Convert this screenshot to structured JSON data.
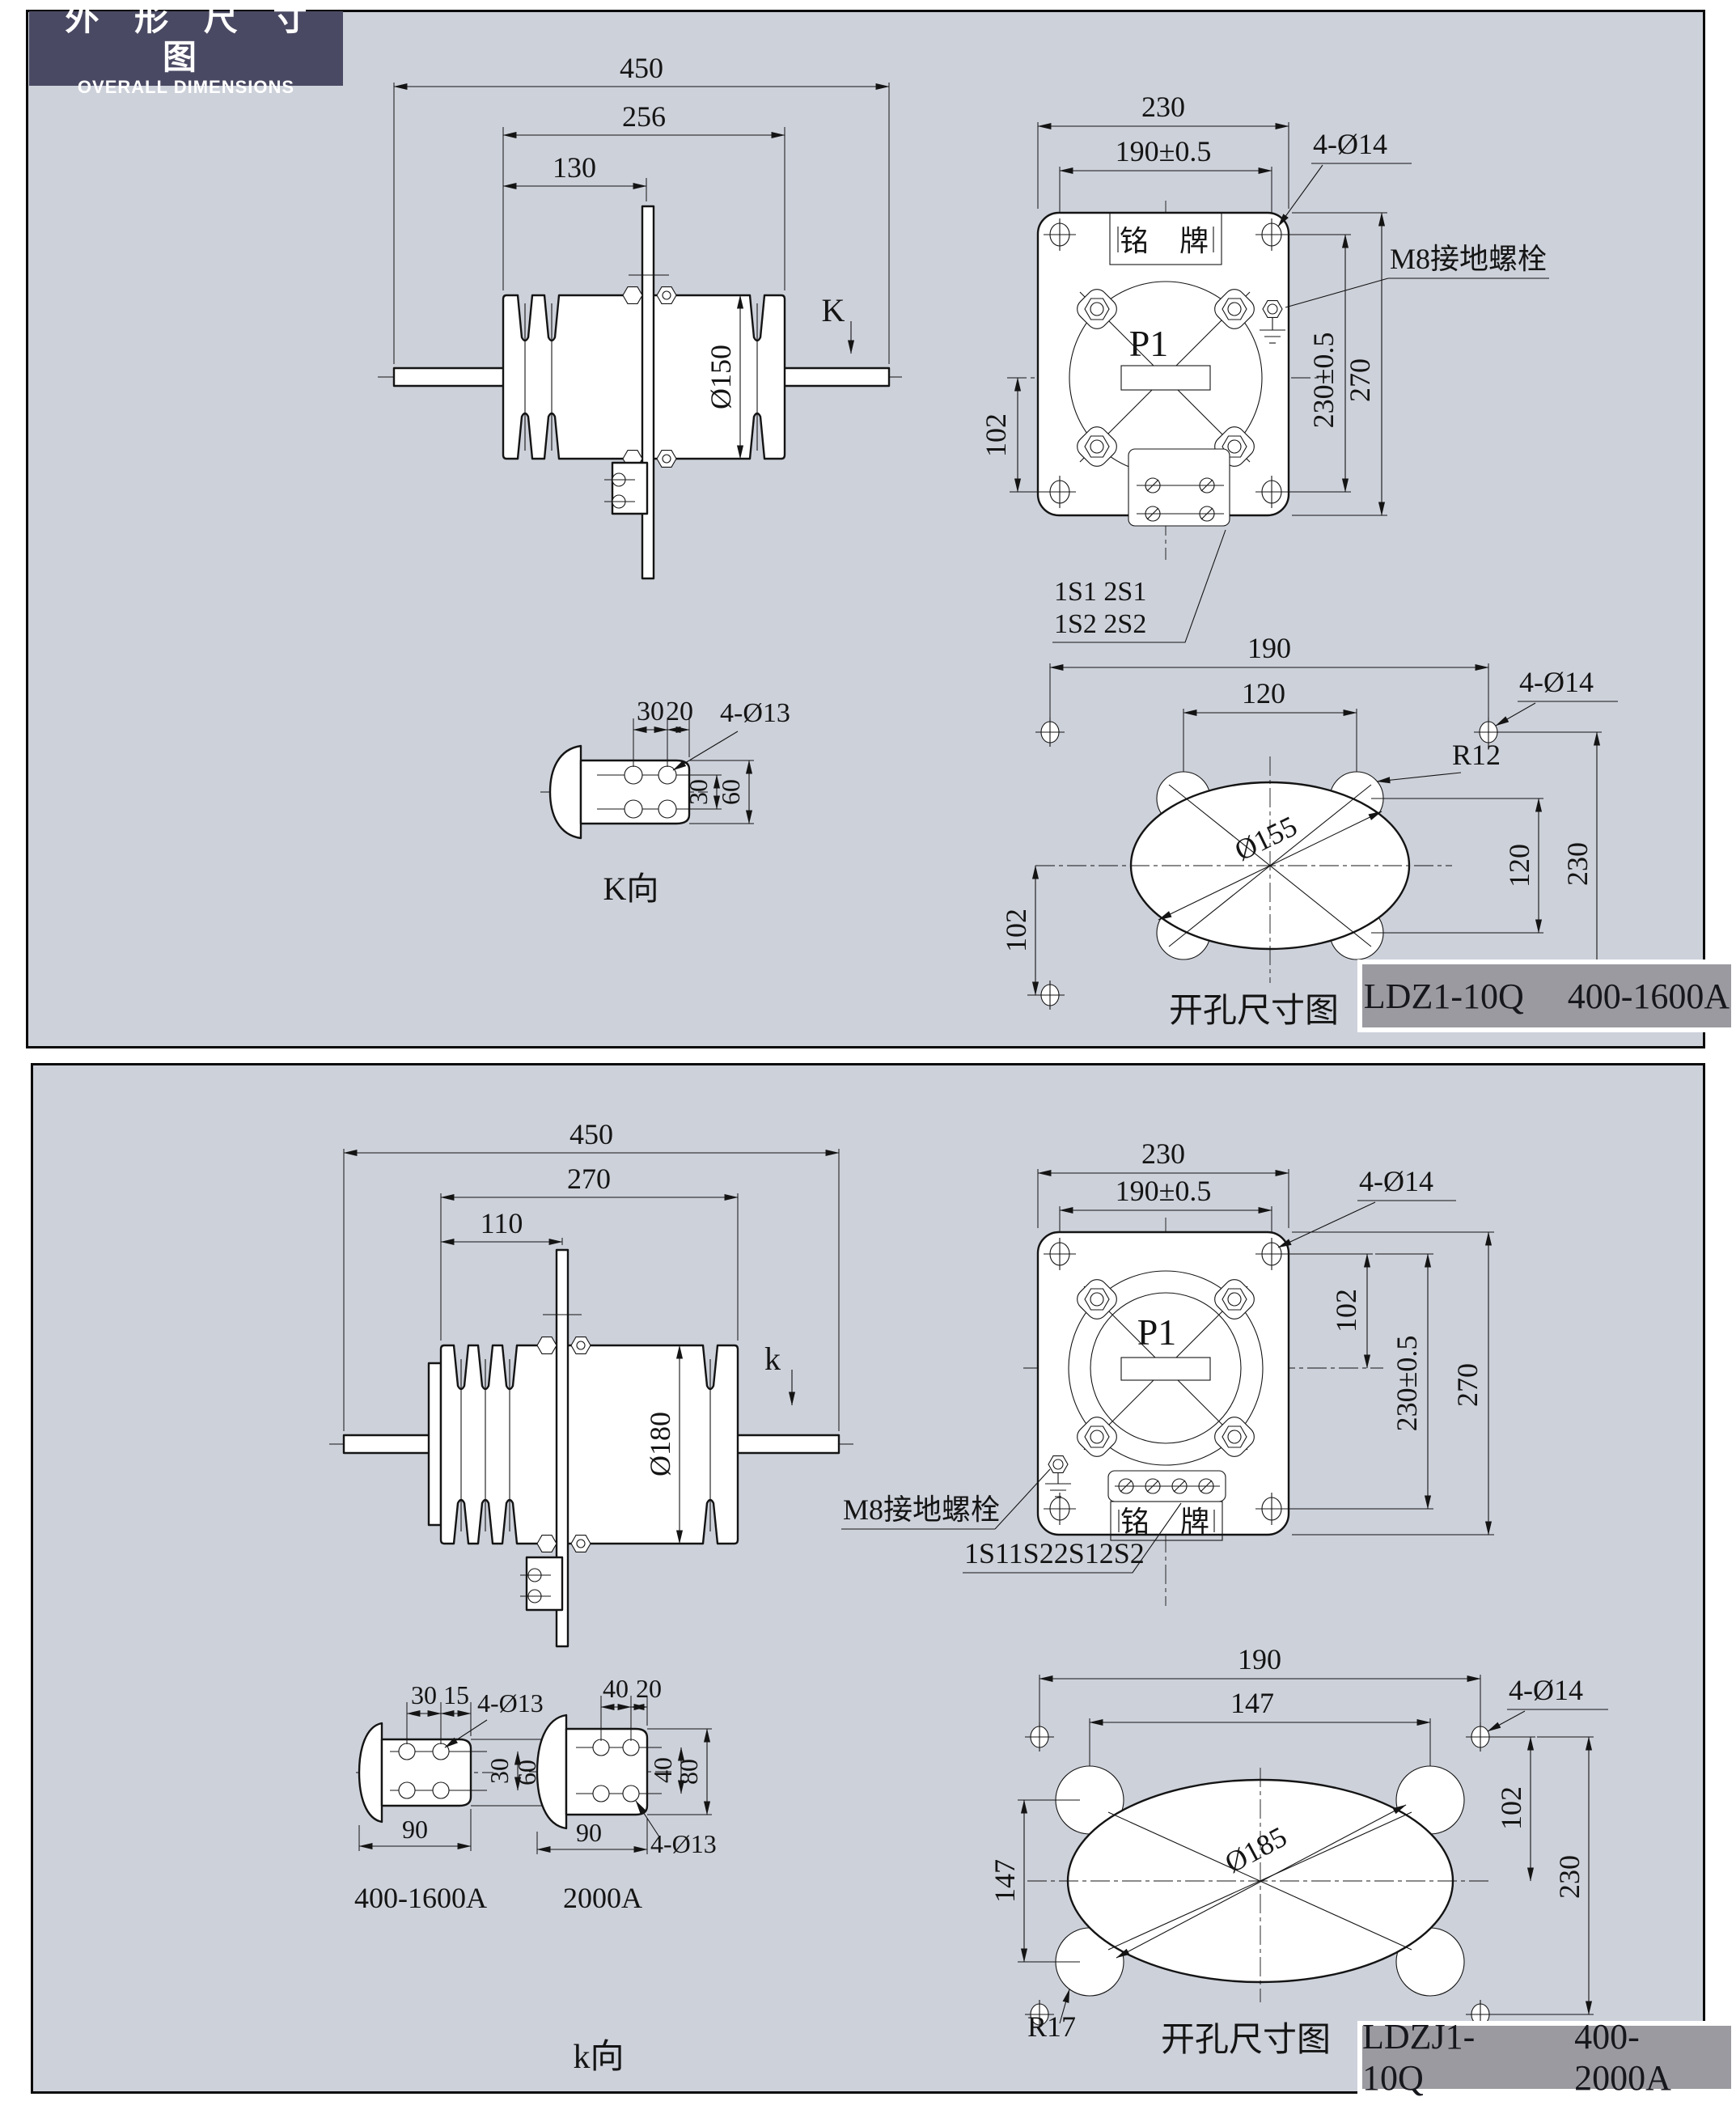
{
  "header": {
    "title_cn": "外 形 尺 寸 图",
    "title_en": "OVERALL DIMENSIONS"
  },
  "panel1": {
    "side_view": {
      "dim_total_length": "450",
      "dim_insulator_length": "256",
      "dim_plate_offset": "130",
      "dim_body_diameter": "Ø150",
      "view_label": "K"
    },
    "flange_view": {
      "dim_width": "230",
      "dim_hole_spacing_h": "190±0.5",
      "mounting_holes_label": "4-Ø14",
      "nameplate_label": "铭牌",
      "ground_bolt_label": "M8接地螺栓",
      "primary_terminal_label": "P1",
      "dim_center_to_bottom_holes": "102",
      "dim_hole_spacing_v": "230±0.5",
      "dim_height": "270",
      "secondary_terminals_row1": "1S1 2S1",
      "secondary_terminals_row2": "1S2 2S2"
    },
    "k_view": {
      "dim_hole_pitch_h": "30",
      "dim_hole_edge": "20",
      "holes_label": "4-Ø13",
      "dim_hole_pitch_v": "30",
      "dim_pad_width": "60",
      "caption": "K向"
    },
    "cutout_view": {
      "dim_hole_spacing_h": "190",
      "dim_lobe_spacing_h": "120",
      "mounting_holes_label": "4-Ø14",
      "lobe_radius_label": "R12",
      "cutout_diameter_label": "Ø155",
      "dim_lobe_spacing_v": "120",
      "dim_hole_spacing_v": "230",
      "dim_center_to_bottom_holes": "102",
      "caption": "开孔尺寸图"
    },
    "label_box": {
      "model": "LDZ1-10Q",
      "current_range": "400-1600A"
    }
  },
  "panel2": {
    "side_view": {
      "dim_total_length": "450",
      "dim_insulator_length": "270",
      "dim_plate_offset": "110",
      "dim_body_diameter": "Ø180",
      "view_label": "k"
    },
    "flange_view": {
      "dim_width": "230",
      "dim_hole_spacing_h": "190±0.5",
      "mounting_holes_label": "4-Ø14",
      "dim_center_to_top_holes": "102",
      "dim_hole_spacing_v": "230±0.5",
      "dim_height": "270",
      "primary_terminal_label": "P1",
      "ground_bolt_label": "M8接地螺栓",
      "secondary_terminals_label": "1S11S22S12S2",
      "nameplate_label": "铭牌"
    },
    "k_view_400_1600": {
      "dim_hole_pitch_h": "30",
      "dim_hole_edge": "15",
      "holes_label": "4-Ø13",
      "dim_hole_pitch_v": "30",
      "dim_pad_width": "60",
      "dim_pad_length": "90",
      "caption": "400-1600A"
    },
    "k_view_2000": {
      "dim_hole_pitch_h": "40",
      "dim_hole_edge": "20",
      "dim_hole_pitch_v": "40",
      "dim_pad_width": "80",
      "dim_pad_length": "90",
      "holes_label": "4-Ø13",
      "caption": "2000A"
    },
    "k_view_caption": "k向",
    "cutout_view": {
      "dim_hole_spacing_h": "190",
      "dim_lobe_spacing_h": "147",
      "mounting_holes_label": "4-Ø14",
      "dim_center_to_top_holes": "102",
      "dim_hole_spacing_v": "230",
      "dim_lobe_spacing_v": "147",
      "cutout_diameter_label": "Ø185",
      "lobe_radius_label": "R17",
      "caption": "开孔尺寸图"
    },
    "label_box": {
      "model": "LDZJ1-10Q",
      "current_range": "400-2000A"
    }
  }
}
